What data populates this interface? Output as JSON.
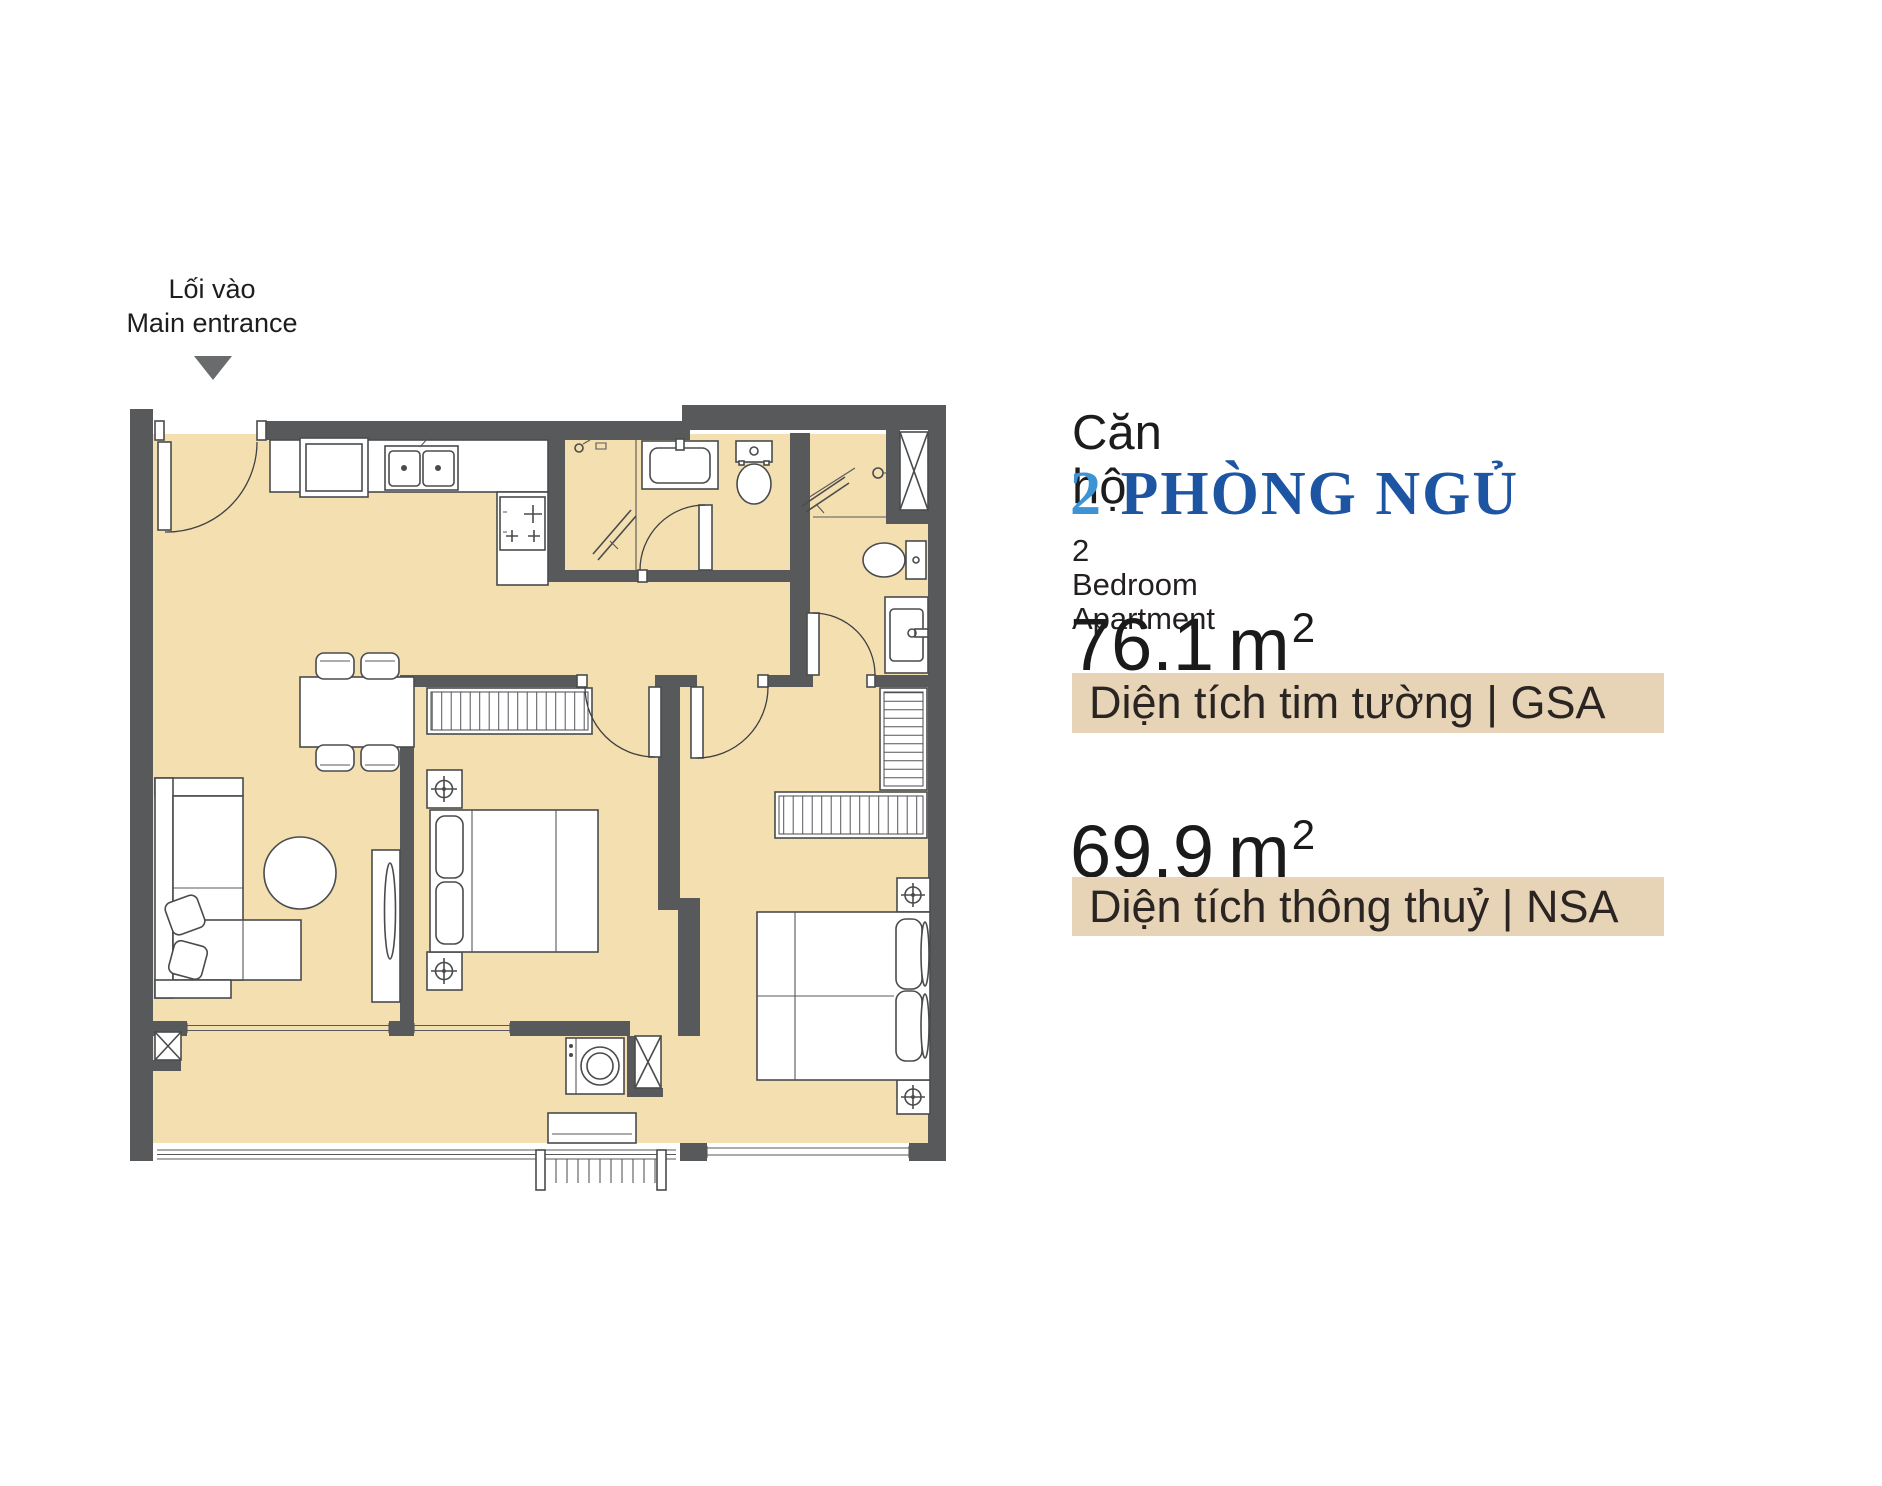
{
  "colors": {
    "wall": "#58595B",
    "floor": "#F3DFB0",
    "band_bg": "#E7D3B6",
    "accent_blue_light": "#3E93D5",
    "accent_blue_dark": "#1D55A2",
    "text_dark": "#231F20",
    "arrow_gray": "#6A6B6D"
  },
  "entrance": {
    "label_vi": "Lối vào",
    "label_en": "Main entrance"
  },
  "unit_info": {
    "category_vi": "Căn hộ",
    "bedrooms_count": "2",
    "type_vi": "PHÒNG NGỦ",
    "type_en": "2 Bedroom Apartment",
    "gsa": {
      "value": "76.1",
      "unit": "m",
      "power": "2",
      "label": "Diện tích tim tường | GSA"
    },
    "nsa": {
      "value": "69.9",
      "unit": "m",
      "power": "2",
      "label": "Diện tích thông thuỷ | NSA"
    }
  }
}
